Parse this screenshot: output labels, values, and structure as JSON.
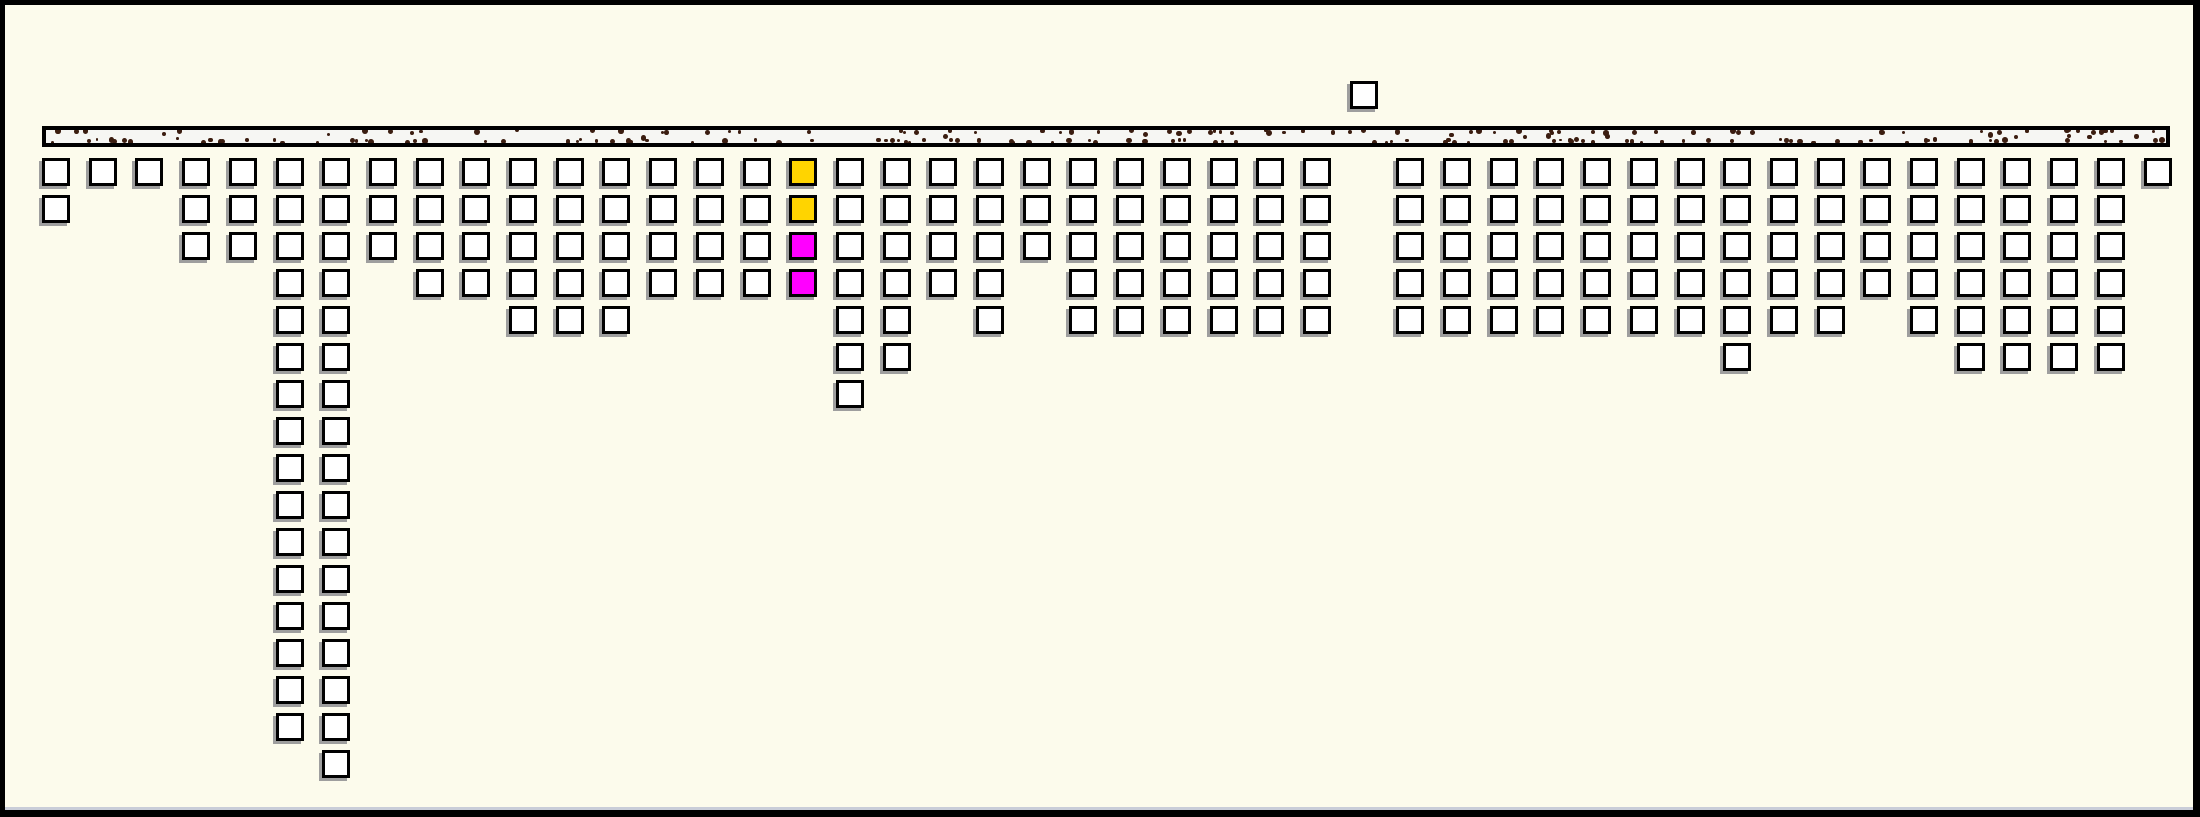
{
  "figure": {
    "width": 2200,
    "height": 817,
    "background_color": "#FCFBEC",
    "frame_border_color": "#000000",
    "bottom_edge_strip_color": "#C9CDD8"
  },
  "band": {
    "x": 37,
    "y": 121,
    "width": 2128,
    "height": 21,
    "border_color": "#000000",
    "fill_color": "#F6F6F3",
    "speckles": {
      "count": 200,
      "color": "#3B1D10",
      "min_radius": 1.4,
      "max_radius": 2.9,
      "seed": 7,
      "distribution": "clustered along top and bottom edges, clipped by band borders"
    }
  },
  "grid": {
    "col_start_x": 37,
    "col_pitch": 46.7,
    "row_start_y": 153,
    "row_pitch": 37,
    "square_outer_size": 28,
    "square_border_px": 3,
    "square_fill": "#FFFFFF",
    "square_border_color": "#000000",
    "shadow_color": "#9E9E9E",
    "shadow_dx": -3,
    "shadow_dy": 3
  },
  "chart_data": {
    "type": "bar",
    "title": "",
    "xlabel": "",
    "ylabel": "",
    "legend": null,
    "grid_on": false,
    "num_columns": 46,
    "unit_square_counts_per_column": [
      2,
      1,
      1,
      3,
      3,
      16,
      17,
      3,
      4,
      4,
      5,
      5,
      5,
      4,
      4,
      4,
      4,
      7,
      6,
      4,
      5,
      3,
      5,
      5,
      5,
      5,
      5,
      5,
      0,
      5,
      5,
      5,
      5,
      5,
      5,
      5,
      6,
      5,
      5,
      4,
      5,
      6,
      6,
      6,
      6,
      1
    ],
    "highlighted_column": {
      "index": 16,
      "cell_colors": [
        "#FFD400",
        "#FFD400",
        "#FF00FF",
        "#FF00FF"
      ]
    },
    "above_band_square": {
      "index": 28,
      "y": 76
    },
    "orientation": "columns of unit squares hang downward from the speckled band"
  }
}
